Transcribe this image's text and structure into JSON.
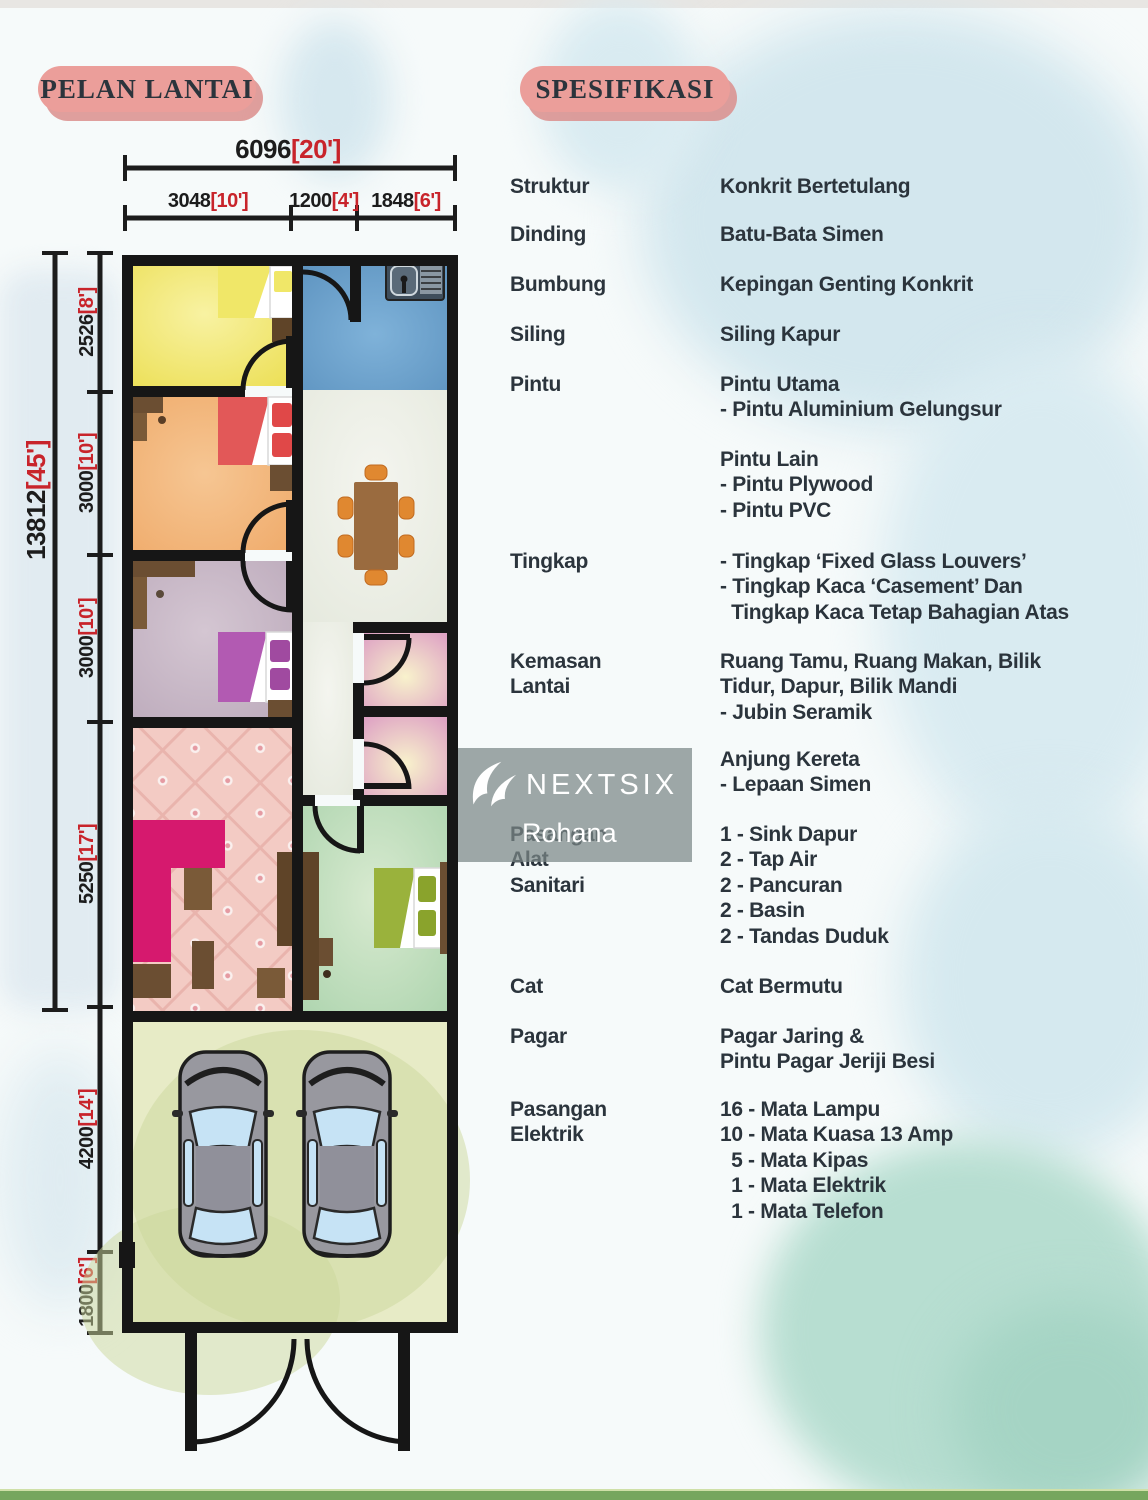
{
  "headers": {
    "floor_plan": "PELAN LANTAI",
    "specification": "SPESIFIKASI"
  },
  "colors": {
    "accent_red": "#c8242b",
    "text_dark": "#2b343c",
    "badge_pink": "#eb9e9a",
    "wall_black": "#161616",
    "strip_green": "#76a65e"
  },
  "watermark": {
    "brand": "NEXTSIX",
    "agent": "Rohana"
  },
  "dimensions": {
    "top_total": {
      "mm": "6096",
      "ft": "[20']"
    },
    "top_segments": [
      {
        "mm": "3048",
        "ft": "[10']"
      },
      {
        "mm": "1200",
        "ft": "[4']"
      },
      {
        "mm": "1848",
        "ft": "[6']"
      }
    ],
    "left_total": {
      "mm": "13812",
      "ft": "[45']"
    },
    "left_segments": [
      {
        "mm": "2526",
        "ft": "[8']"
      },
      {
        "mm": "3000",
        "ft": "[10']"
      },
      {
        "mm": "3000",
        "ft": "[10']"
      },
      {
        "mm": "5250",
        "ft": "[17']"
      },
      {
        "mm": "4200",
        "ft": "[14']"
      },
      {
        "mm": "1800",
        "ft": "[6']"
      }
    ]
  },
  "specifications": [
    {
      "label_lines": [
        "Struktur"
      ],
      "lines": [
        "Konkrit Bertetulang"
      ]
    },
    {
      "label_lines": [
        "Dinding"
      ],
      "lines": [
        "Batu-Bata Simen"
      ]
    },
    {
      "label_lines": [
        "Bumbung"
      ],
      "lines": [
        "Kepingan Genting Konkrit"
      ]
    },
    {
      "label_lines": [
        "Siling"
      ],
      "lines": [
        "Siling Kapur"
      ]
    },
    {
      "label_lines": [
        "Pintu"
      ],
      "lines": [
        "Pintu Utama",
        "- Pintu Aluminium Gelungsur"
      ]
    },
    {
      "label_lines": [],
      "lines": [
        "Pintu Lain",
        "- Pintu Plywood",
        "- Pintu PVC"
      ]
    },
    {
      "label_lines": [
        "Tingkap"
      ],
      "lines": [
        "- Tingkap ‘Fixed Glass Louvers’",
        "- Tingkap Kaca ‘Casement’ Dan",
        "  Tingkap Kaca Tetap Bahagian Atas"
      ]
    },
    {
      "label_lines": [
        "Kemasan",
        "Lantai"
      ],
      "lines": [
        "Ruang Tamu, Ruang Makan, Bilik",
        "Tidur, Dapur, Bilik Mandi",
        "- Jubin Seramik"
      ]
    },
    {
      "label_lines": [],
      "lines": [
        "Anjung Kereta",
        "- Lepaan Simen"
      ]
    },
    {
      "label_lines": [
        "Pasangan",
        "Alat",
        "Sanitari"
      ],
      "lines": [
        "1 - Sink Dapur",
        "2 - Tap Air",
        "2 - Pancuran",
        "2 - Basin",
        "2 - Tandas Duduk"
      ]
    },
    {
      "label_lines": [
        "Cat"
      ],
      "lines": [
        "Cat Bermutu"
      ]
    },
    {
      "label_lines": [
        "Pagar"
      ],
      "lines": [
        "Pagar Jaring &",
        "Pintu Pagar Jeriji Besi"
      ]
    },
    {
      "label_lines": [
        "Pasangan",
        "Elektrik"
      ],
      "lines": [
        "16 - Mata Lampu",
        "10 - Mata Kuasa 13 Amp",
        "  5 - Mata Kipas",
        "  1 - Mata Elektrik",
        "  1 - Mata Telefon"
      ]
    }
  ]
}
